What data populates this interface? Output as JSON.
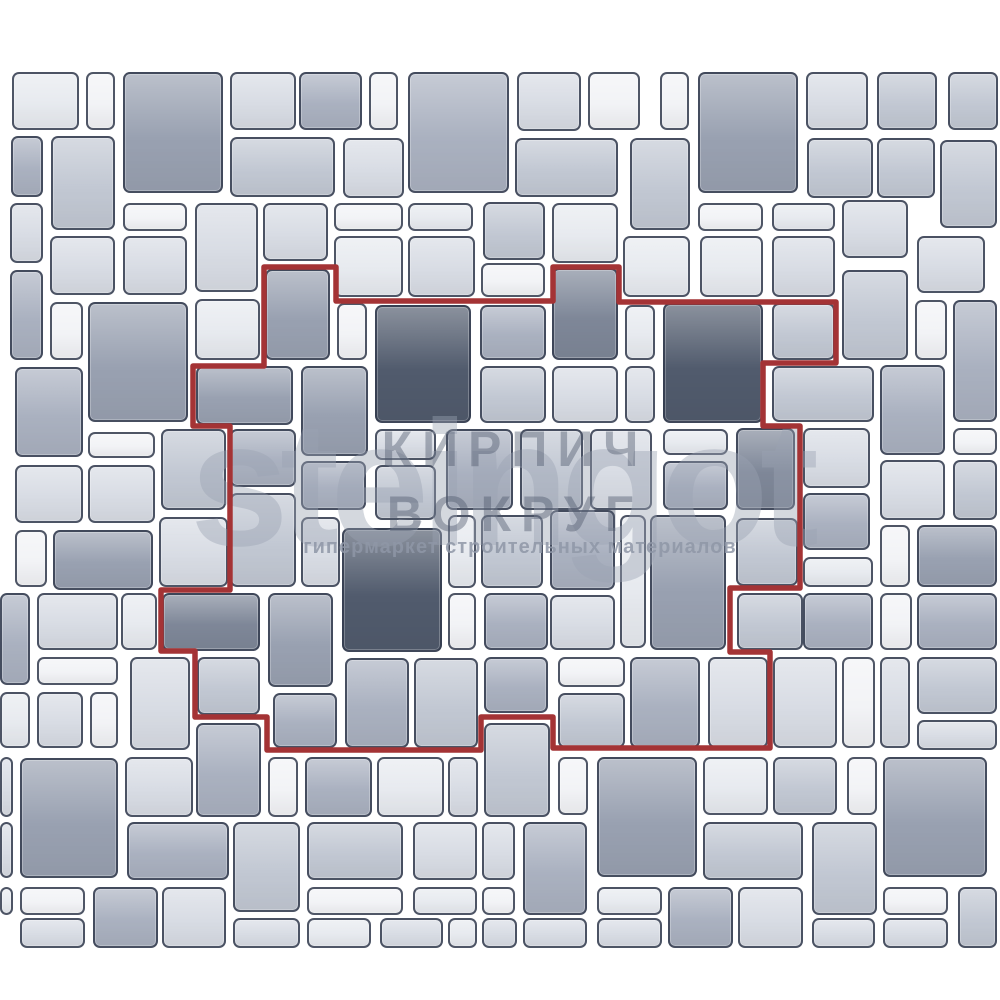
{
  "image": {
    "kind": "paving-stone laying pattern illustration",
    "canvas": {
      "width": 1000,
      "height": 1000,
      "background": "#ffffff"
    }
  },
  "palette": {
    "joint": "#ffffff",
    "tile_border": "#333b4d",
    "tile_colors": [
      "#f2f3f6",
      "#e7eaef",
      "#d8dce4",
      "#c2c8d3",
      "#aab1c0",
      "#99a1b1",
      "#7e8798",
      "#515b6d"
    ],
    "repeat_outline": "#a43335"
  },
  "watermark": {
    "logo_text": "steingot",
    "overlay_line1": "КИРПИЧ",
    "overlay_line2": "ВОКРУГ",
    "tagline": "гипермаркет строительных материалов"
  },
  "repeat_outline": {
    "color": "#a43335",
    "stroke_width": 5.5,
    "points": [
      [
        264,
        267
      ],
      [
        336,
        267
      ],
      [
        336,
        301
      ],
      [
        553,
        301
      ],
      [
        553,
        267
      ],
      [
        619,
        267
      ],
      [
        619,
        302
      ],
      [
        836,
        302
      ],
      [
        836,
        363
      ],
      [
        763,
        363
      ],
      [
        763,
        426
      ],
      [
        800,
        426
      ],
      [
        800,
        588
      ],
      [
        730,
        588
      ],
      [
        730,
        652
      ],
      [
        770,
        652
      ],
      [
        770,
        748
      ],
      [
        553,
        748
      ],
      [
        553,
        717
      ],
      [
        481,
        717
      ],
      [
        481,
        750
      ],
      [
        267,
        750
      ],
      [
        267,
        717
      ],
      [
        195,
        717
      ],
      [
        195,
        651
      ],
      [
        161,
        651
      ],
      [
        161,
        590
      ],
      [
        230,
        590
      ],
      [
        230,
        426
      ],
      [
        193,
        426
      ],
      [
        193,
        366
      ],
      [
        264,
        366
      ]
    ]
  },
  "pattern": {
    "tiles": [
      [
        12,
        72,
        67,
        58,
        1
      ],
      [
        86,
        72,
        29,
        58,
        0
      ],
      [
        123,
        72,
        100,
        121,
        5
      ],
      [
        230,
        72,
        66,
        58,
        2
      ],
      [
        299,
        72,
        63,
        58,
        4
      ],
      [
        369,
        72,
        29,
        58,
        0
      ],
      [
        408,
        72,
        101,
        121,
        4
      ],
      [
        517,
        72,
        64,
        59,
        2
      ],
      [
        588,
        72,
        52,
        58,
        0
      ],
      [
        660,
        72,
        29,
        58,
        0
      ],
      [
        698,
        72,
        100,
        121,
        5
      ],
      [
        806,
        72,
        62,
        58,
        2
      ],
      [
        877,
        72,
        60,
        58,
        3
      ],
      [
        948,
        72,
        50,
        58,
        3
      ],
      [
        11,
        136,
        32,
        61,
        4
      ],
      [
        51,
        136,
        64,
        94,
        3
      ],
      [
        230,
        137,
        105,
        60,
        3
      ],
      [
        343,
        138,
        61,
        60,
        2
      ],
      [
        515,
        138,
        103,
        59,
        3
      ],
      [
        630,
        138,
        60,
        92,
        3
      ],
      [
        807,
        138,
        66,
        60,
        3
      ],
      [
        877,
        138,
        58,
        60,
        3
      ],
      [
        940,
        140,
        57,
        88,
        3
      ],
      [
        10,
        203,
        33,
        60,
        2
      ],
      [
        123,
        203,
        64,
        28,
        0
      ],
      [
        195,
        203,
        63,
        89,
        2
      ],
      [
        263,
        203,
        65,
        58,
        2
      ],
      [
        334,
        203,
        69,
        28,
        0
      ],
      [
        408,
        203,
        65,
        28,
        1
      ],
      [
        483,
        202,
        62,
        58,
        3
      ],
      [
        552,
        203,
        66,
        60,
        1
      ],
      [
        698,
        203,
        65,
        28,
        0
      ],
      [
        772,
        203,
        63,
        28,
        1
      ],
      [
        842,
        200,
        66,
        58,
        2
      ],
      [
        50,
        236,
        65,
        59,
        2
      ],
      [
        123,
        236,
        64,
        59,
        2
      ],
      [
        334,
        236,
        69,
        61,
        1
      ],
      [
        408,
        236,
        67,
        61,
        2
      ],
      [
        481,
        263,
        64,
        34,
        0
      ],
      [
        623,
        236,
        67,
        61,
        1
      ],
      [
        700,
        236,
        63,
        61,
        1
      ],
      [
        772,
        236,
        63,
        61,
        2
      ],
      [
        917,
        236,
        68,
        57,
        2
      ],
      [
        10,
        270,
        33,
        90,
        4
      ],
      [
        50,
        302,
        33,
        58,
        0
      ],
      [
        88,
        302,
        100,
        120,
        5
      ],
      [
        195,
        299,
        65,
        61,
        1
      ],
      [
        265,
        269,
        65,
        91,
        5
      ],
      [
        337,
        303,
        30,
        57,
        0
      ],
      [
        375,
        305,
        96,
        118,
        7
      ],
      [
        480,
        305,
        66,
        55,
        4
      ],
      [
        552,
        268,
        66,
        92,
        6
      ],
      [
        625,
        305,
        30,
        55,
        1
      ],
      [
        663,
        303,
        100,
        120,
        7
      ],
      [
        772,
        303,
        63,
        57,
        3
      ],
      [
        842,
        270,
        66,
        90,
        3
      ],
      [
        915,
        300,
        32,
        60,
        0
      ],
      [
        953,
        300,
        44,
        122,
        4
      ],
      [
        15,
        367,
        68,
        90,
        4
      ],
      [
        196,
        366,
        97,
        59,
        5
      ],
      [
        301,
        366,
        67,
        90,
        5
      ],
      [
        480,
        366,
        66,
        57,
        3
      ],
      [
        552,
        366,
        66,
        57,
        2
      ],
      [
        625,
        366,
        30,
        57,
        2
      ],
      [
        772,
        366,
        102,
        56,
        3
      ],
      [
        880,
        365,
        65,
        90,
        4
      ],
      [
        88,
        432,
        67,
        26,
        0
      ],
      [
        161,
        429,
        65,
        81,
        3
      ],
      [
        230,
        429,
        66,
        58,
        4
      ],
      [
        301,
        461,
        65,
        49,
        4
      ],
      [
        375,
        429,
        61,
        31,
        2
      ],
      [
        375,
        465,
        61,
        55,
        3
      ],
      [
        446,
        429,
        67,
        81,
        4
      ],
      [
        520,
        429,
        63,
        81,
        3
      ],
      [
        590,
        429,
        62,
        81,
        2
      ],
      [
        663,
        429,
        65,
        26,
        1
      ],
      [
        663,
        461,
        65,
        49,
        4
      ],
      [
        736,
        428,
        59,
        82,
        6
      ],
      [
        803,
        428,
        67,
        60,
        2
      ],
      [
        953,
        428,
        44,
        27,
        0
      ],
      [
        880,
        460,
        65,
        60,
        2
      ],
      [
        953,
        460,
        44,
        60,
        3
      ],
      [
        15,
        465,
        68,
        58,
        2
      ],
      [
        88,
        465,
        67,
        58,
        2
      ],
      [
        230,
        493,
        66,
        94,
        3
      ],
      [
        301,
        517,
        39,
        70,
        2
      ],
      [
        342,
        528,
        100,
        124,
        7
      ],
      [
        448,
        515,
        28,
        73,
        1
      ],
      [
        481,
        515,
        62,
        73,
        3
      ],
      [
        550,
        510,
        65,
        80,
        4
      ],
      [
        620,
        515,
        26,
        133,
        1
      ],
      [
        650,
        515,
        76,
        135,
        5
      ],
      [
        736,
        518,
        62,
        68,
        3
      ],
      [
        803,
        493,
        67,
        57,
        4
      ],
      [
        15,
        530,
        32,
        57,
        0
      ],
      [
        53,
        530,
        100,
        60,
        5
      ],
      [
        159,
        517,
        69,
        70,
        2
      ],
      [
        880,
        525,
        30,
        62,
        0
      ],
      [
        917,
        525,
        80,
        62,
        5
      ],
      [
        0,
        593,
        30,
        92,
        4
      ],
      [
        37,
        593,
        81,
        57,
        2
      ],
      [
        121,
        593,
        36,
        57,
        1
      ],
      [
        162,
        593,
        98,
        58,
        6
      ],
      [
        268,
        593,
        65,
        94,
        5
      ],
      [
        448,
        593,
        28,
        57,
        0
      ],
      [
        484,
        593,
        64,
        57,
        4
      ],
      [
        550,
        595,
        65,
        55,
        2
      ],
      [
        737,
        593,
        66,
        57,
        3
      ],
      [
        803,
        557,
        70,
        30,
        1
      ],
      [
        803,
        593,
        70,
        57,
        4
      ],
      [
        880,
        593,
        32,
        57,
        0
      ],
      [
        917,
        593,
        80,
        57,
        4
      ],
      [
        37,
        657,
        81,
        28,
        0
      ],
      [
        0,
        692,
        30,
        56,
        1
      ],
      [
        37,
        692,
        46,
        56,
        2
      ],
      [
        90,
        692,
        28,
        56,
        0
      ],
      [
        130,
        657,
        60,
        93,
        2
      ],
      [
        197,
        657,
        63,
        58,
        3
      ],
      [
        273,
        693,
        64,
        55,
        4
      ],
      [
        345,
        658,
        64,
        90,
        4
      ],
      [
        414,
        658,
        64,
        90,
        3
      ],
      [
        484,
        657,
        64,
        56,
        4
      ],
      [
        558,
        657,
        67,
        30,
        0
      ],
      [
        558,
        693,
        67,
        55,
        3
      ],
      [
        630,
        657,
        70,
        91,
        4
      ],
      [
        708,
        657,
        60,
        91,
        2
      ],
      [
        773,
        657,
        64,
        91,
        2
      ],
      [
        842,
        657,
        33,
        91,
        0
      ],
      [
        880,
        657,
        30,
        91,
        2
      ],
      [
        917,
        657,
        80,
        57,
        3
      ],
      [
        917,
        720,
        80,
        30,
        2
      ],
      [
        0,
        757,
        13,
        60,
        2
      ],
      [
        20,
        758,
        98,
        120,
        5
      ],
      [
        125,
        757,
        68,
        60,
        2
      ],
      [
        196,
        723,
        65,
        94,
        4
      ],
      [
        268,
        757,
        30,
        60,
        0
      ],
      [
        305,
        757,
        67,
        60,
        4
      ],
      [
        377,
        757,
        67,
        60,
        1
      ],
      [
        448,
        757,
        30,
        60,
        2
      ],
      [
        484,
        723,
        66,
        94,
        3
      ],
      [
        558,
        757,
        30,
        58,
        0
      ],
      [
        597,
        757,
        100,
        120,
        5
      ],
      [
        703,
        757,
        65,
        58,
        1
      ],
      [
        773,
        757,
        64,
        58,
        3
      ],
      [
        847,
        757,
        30,
        58,
        0
      ],
      [
        883,
        757,
        104,
        120,
        5
      ],
      [
        0,
        822,
        13,
        56,
        2
      ],
      [
        127,
        822,
        102,
        58,
        4
      ],
      [
        233,
        822,
        67,
        90,
        3
      ],
      [
        307,
        822,
        96,
        58,
        3
      ],
      [
        413,
        822,
        64,
        58,
        2
      ],
      [
        482,
        822,
        33,
        58,
        2
      ],
      [
        523,
        822,
        64,
        93,
        4
      ],
      [
        703,
        822,
        100,
        58,
        3
      ],
      [
        812,
        822,
        65,
        93,
        3
      ],
      [
        0,
        887,
        13,
        28,
        1
      ],
      [
        20,
        887,
        65,
        28,
        0
      ],
      [
        93,
        887,
        65,
        61,
        4
      ],
      [
        162,
        887,
        64,
        61,
        2
      ],
      [
        307,
        887,
        96,
        28,
        0
      ],
      [
        413,
        887,
        64,
        28,
        1
      ],
      [
        482,
        887,
        33,
        28,
        0
      ],
      [
        597,
        887,
        65,
        28,
        1
      ],
      [
        668,
        887,
        65,
        61,
        4
      ],
      [
        738,
        887,
        65,
        61,
        2
      ],
      [
        883,
        887,
        65,
        28,
        0
      ],
      [
        958,
        887,
        39,
        61,
        3
      ],
      [
        20,
        918,
        65,
        30,
        2
      ],
      [
        233,
        918,
        67,
        30,
        2
      ],
      [
        307,
        918,
        64,
        30,
        1
      ],
      [
        380,
        918,
        63,
        30,
        2
      ],
      [
        448,
        918,
        29,
        30,
        1
      ],
      [
        482,
        918,
        35,
        30,
        2
      ],
      [
        523,
        918,
        64,
        30,
        2
      ],
      [
        597,
        918,
        65,
        30,
        2
      ],
      [
        812,
        918,
        63,
        30,
        2
      ],
      [
        883,
        918,
        65,
        30,
        2
      ]
    ]
  }
}
